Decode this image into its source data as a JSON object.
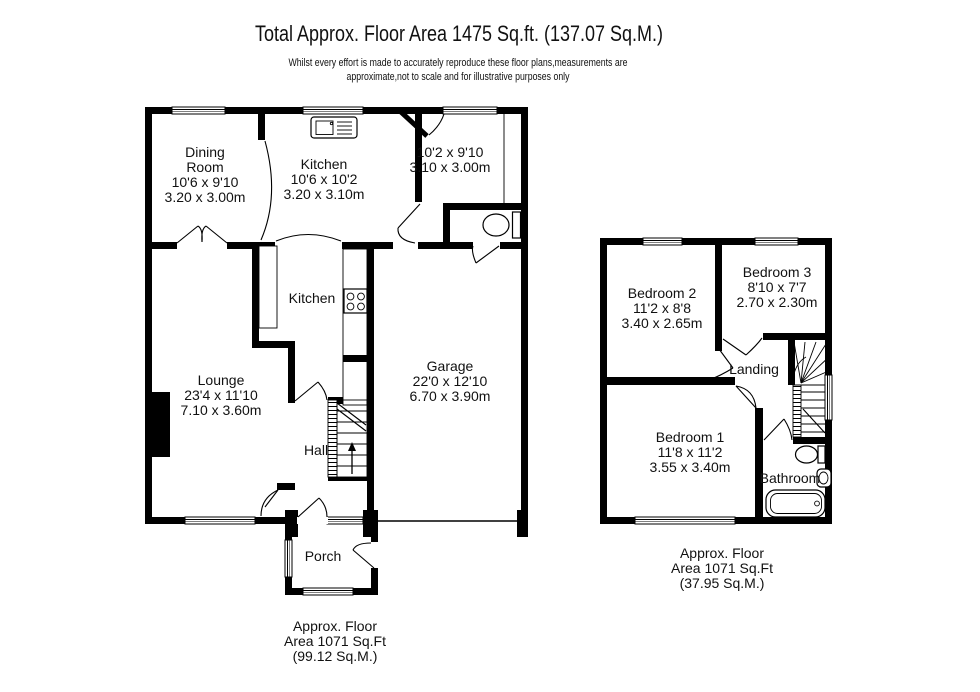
{
  "header": {
    "title": "Total Approx. Floor Area 1475 Sq.ft. (137.07 Sq.M.)",
    "disclaimer_line1": "Whilst every effort is made to accurately reproduce these floor plans,measurements are",
    "disclaimer_line2": "approximate,not to scale and for illustrative purposes only"
  },
  "ground_floor": {
    "rooms": {
      "dining_room": {
        "name_line1": "Dining",
        "name_line2": "Room",
        "imperial": "10'6 x 9'10",
        "metric": "3.20 x 3.00m"
      },
      "kitchen": {
        "name": "Kitchen",
        "imperial": "10'6 x 10'2",
        "metric": "3.20 x 3.10m"
      },
      "rear_room": {
        "imperial": "10'2 x 9'10",
        "metric": "3.10 x 3.00m"
      },
      "kitchen_area": {
        "name": "Kitchen"
      },
      "lounge": {
        "name": "Lounge",
        "imperial": "23'4 x 11'10",
        "metric": "7.10 x 3.60m"
      },
      "garage": {
        "name": "Garage",
        "imperial": "22'0 x 12'10",
        "metric": "6.70 x 3.90m"
      },
      "hall": {
        "name": "Hall"
      },
      "porch": {
        "name": "Porch"
      }
    },
    "area_label": {
      "line1": "Approx. Floor",
      "line2": "Area 1071 Sq.Ft",
      "line3": "(99.12 Sq.M.)"
    }
  },
  "first_floor": {
    "rooms": {
      "bedroom_2": {
        "name": "Bedroom 2",
        "imperial": "11'2 x 8'8",
        "metric": "3.40 x 2.65m"
      },
      "bedroom_3": {
        "name": "Bedroom 3",
        "imperial": "8'10 x 7'7",
        "metric": "2.70 x 2.30m"
      },
      "bedroom_1": {
        "name": "Bedroom 1",
        "imperial": "11'8 x 11'2",
        "metric": "3.55 x 3.40m"
      },
      "landing": {
        "name": "Landing"
      },
      "bathroom": {
        "name": "Bathroom"
      }
    },
    "area_label": {
      "line1": "Approx. Floor",
      "line2": "Area 1071 Sq.Ft",
      "line3": "(37.95 Sq.M.)"
    }
  },
  "icons": {
    "sink": "sink-icon",
    "hob": "hob-icon",
    "toilet": "toilet-icon",
    "bath": "bathtub-icon",
    "basin": "basin-icon",
    "stairs": "staircase-icon"
  },
  "colors": {
    "background": "#ffffff",
    "walls": "#000000",
    "text": "#111111"
  }
}
